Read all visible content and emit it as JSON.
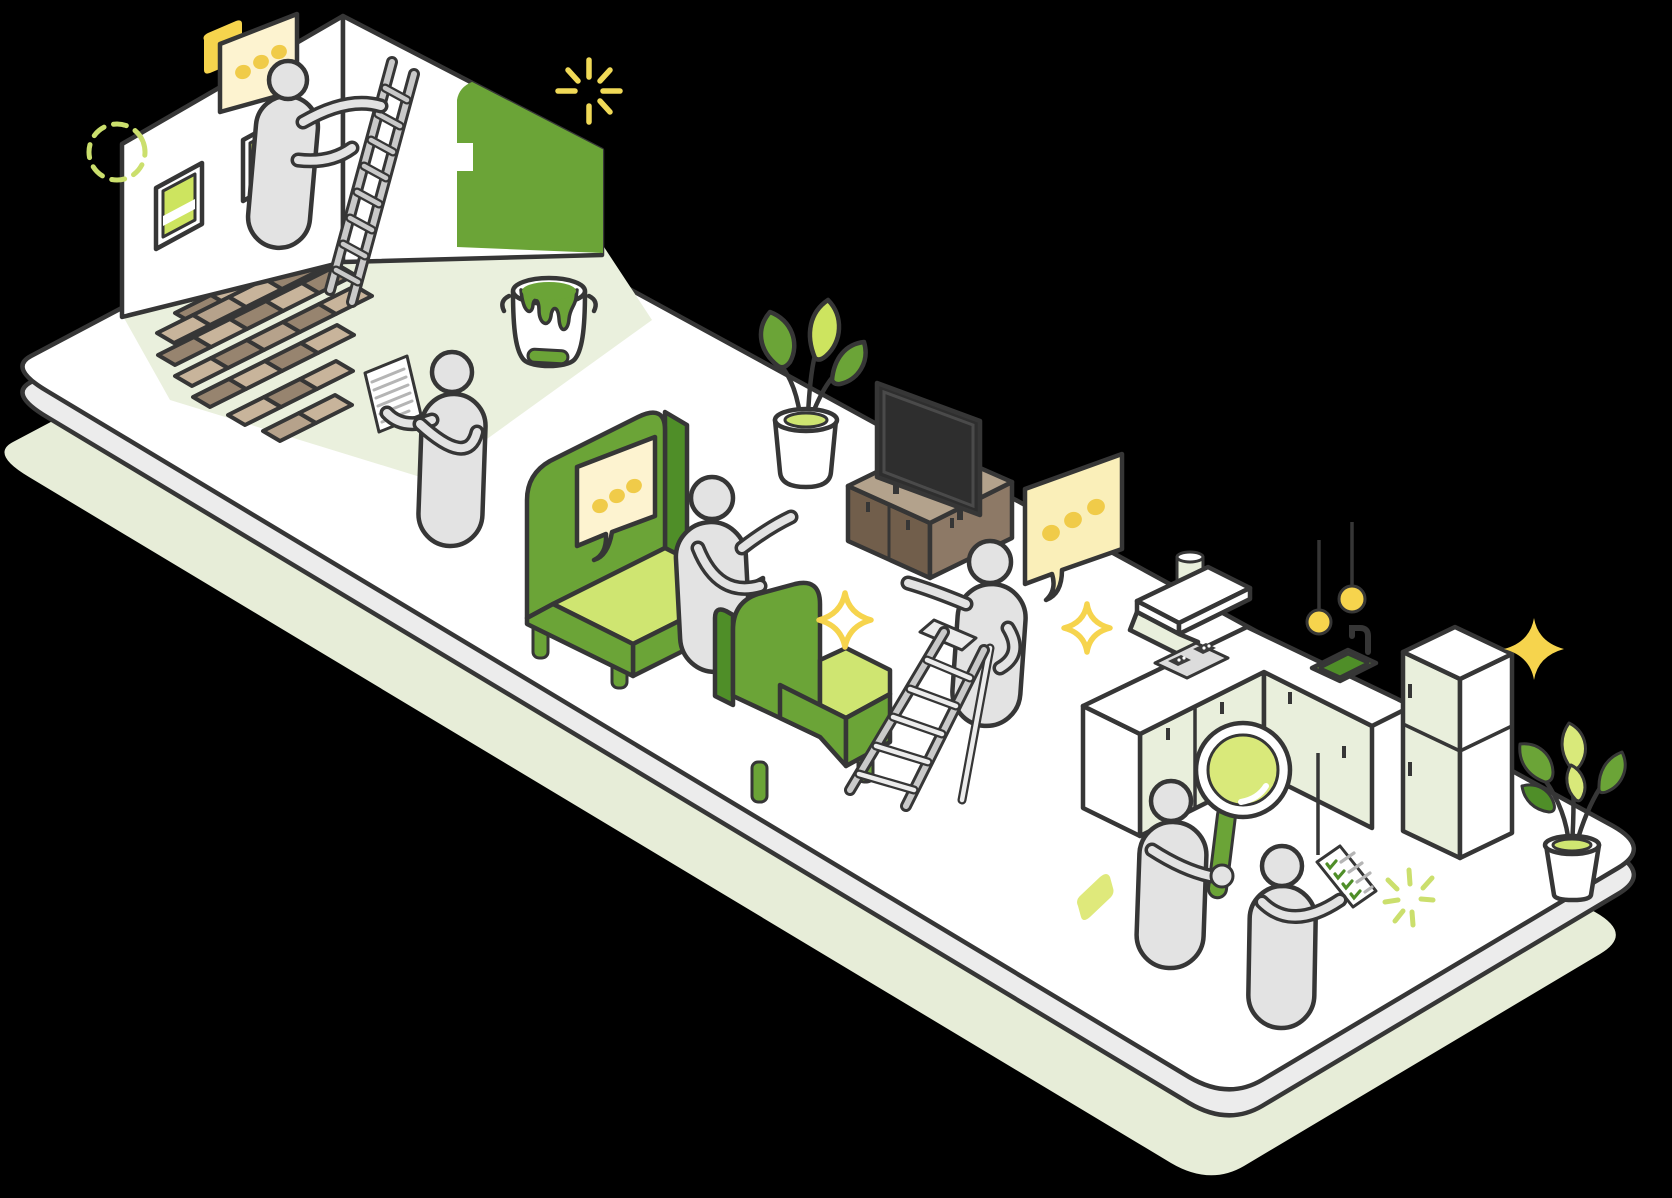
{
  "scene": {
    "type": "isometric-illustration",
    "subject": "Home renovation and interior design activities on a floating isometric platform",
    "background": "#000000",
    "objects": [
      "room-corner-walls",
      "wall-windows",
      "green-painted-wall",
      "painter-on-ladder",
      "speech-bubble-dots",
      "dashed-circle-decoration",
      "tile-floor-bricks",
      "paint-bucket",
      "person-reading-document",
      "green-sofa-with-speech-bubble",
      "person-presenting",
      "green-armchair",
      "potted-plant",
      "tv-on-media-console",
      "person-on-stepladder",
      "kitchen-counter-with-hood-cooktop-sink",
      "pendant-lamps",
      "refrigerator",
      "person-with-magnifying-glass",
      "person-with-checklist",
      "potted-plant-small",
      "sparkle-decorations"
    ]
  },
  "palette": {
    "bg": "#000000",
    "outline": "#363636",
    "white": "#ffffff",
    "body-grey": "#e3e3e3",
    "grey-mid": "#c9c9c9",
    "grey-light": "#ececec",
    "line-grey": "#b5b5b5",
    "shadow-green": "#e7edd8",
    "floor-green": "#eaf0dd",
    "pale-green": "#e9efdc",
    "green-main": "#6ba437",
    "green-dark": "#4f8e28",
    "green-light": "#cfe571",
    "glass-green": "#cde45f",
    "lens-green": "#d9e97a",
    "deco-green": "#cbdf6d",
    "yellow": "#f6d44d",
    "dot-yellow": "#f0cb49",
    "cream": "#fdf3d0",
    "cream-deep": "#faefb9",
    "brick-light": "#c8b49b",
    "brick-dark": "#97846f",
    "brick-mid": "#b6a28b",
    "wood-top": "#b3a28c",
    "wood-front": "#715e4b",
    "wood-side": "#8d7966",
    "tv-screen": "#2e2e2e"
  },
  "bricks": {
    "u": [
      36,
      -18
    ],
    "v": [
      17,
      10
    ],
    "rows": [
      [
        210,
        298,
        3
      ],
      [
        175,
        313,
        4
      ],
      [
        157,
        333,
        5
      ],
      [
        158,
        355,
        5
      ],
      [
        175,
        376,
        5
      ],
      [
        193,
        397,
        4
      ],
      [
        228,
        415,
        3
      ],
      [
        263,
        431,
        2
      ]
    ]
  }
}
